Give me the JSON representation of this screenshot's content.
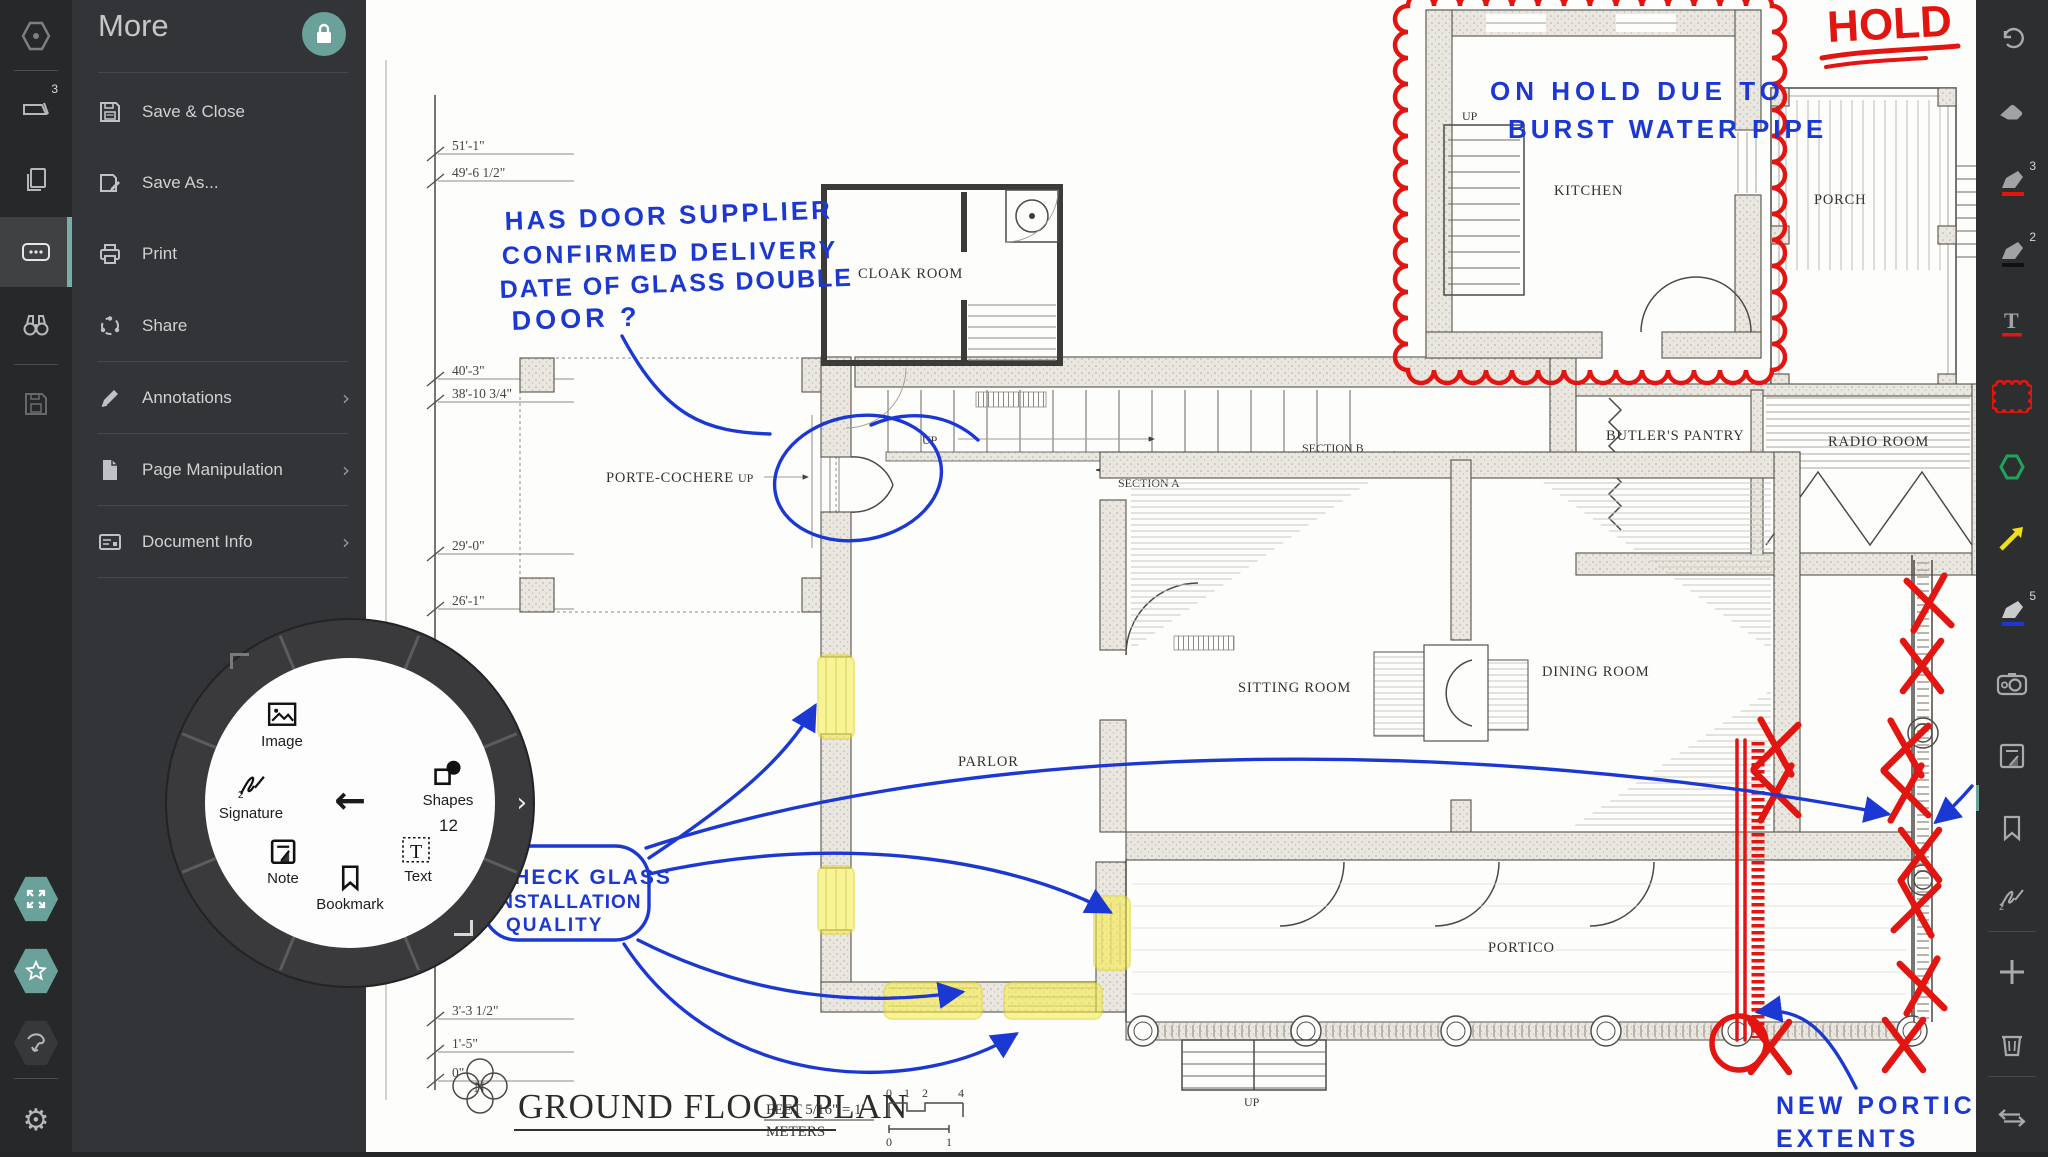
{
  "ui": {
    "more_panel": {
      "title": "More",
      "items": [
        {
          "label": "Save & Close"
        },
        {
          "label": "Save As..."
        },
        {
          "label": "Print"
        },
        {
          "label": "Share"
        },
        {
          "label": "Annotations"
        },
        {
          "label": "Page Manipulation"
        },
        {
          "label": "Document Info"
        }
      ]
    },
    "rail": {
      "documents_badge": "3"
    },
    "radial_menu": {
      "image": "Image",
      "signature": "Signature",
      "note": "Note",
      "bookmark": "Bookmark",
      "text": "Text",
      "shapes": "Shapes",
      "text_size": "12"
    },
    "toolbar": {
      "pen_red_badge": "3",
      "pen_black_badge": "2",
      "pen_blue_badge": "5"
    }
  },
  "plan": {
    "title": "GROUND FLOOR PLAN",
    "compass": "N",
    "up": "UP",
    "rooms": {
      "cloak": "CLOAK ROOM",
      "kitchen": "KITCHEN",
      "porch": "PORCH",
      "porte_cochere": "PORTE-COCHERE",
      "stair_hall": "STAIR HALL",
      "section_a": "SECTION A",
      "section_b": "SECTION B",
      "parlor": "PARLOR",
      "sitting": "SITTING ROOM",
      "dining": "DINING ROOM",
      "butlers": "BUTLER'S PANTRY",
      "radio": "RADIO ROOM",
      "portico": "PORTICO"
    },
    "dims": [
      "51'-1\"",
      "49'-6 1/2\"",
      "40'-3\"",
      "38'-10 3/4\"",
      "29'-0\"",
      "26'-1\"",
      "3'-3 1/2\"",
      "1'-5\"",
      "0\""
    ],
    "scale": {
      "feet": "FEET 5/16\" = 1'",
      "meters": "METERS",
      "feet_ticks": [
        "0",
        "1",
        "2",
        "4"
      ],
      "meter_ticks": [
        "0",
        "1"
      ]
    },
    "ink": {
      "hold": "HOLD",
      "on_hold_1": "ON HOLD DUE TO",
      "on_hold_2": "BURST WATER PIPE",
      "door_q_1": "HAS DOOR SUPPLIER",
      "door_q_2": "CONFIRMED DELIVERY",
      "door_q_3": "DATE OF GLASS DOUBLE",
      "door_q_4": "DOOR ?",
      "glass_1": "CHECK GLASS",
      "glass_2": "INSTALLATION",
      "glass_3": "QUALITY",
      "portico_1": "NEW PORTICO",
      "portico_2": "EXTENTS"
    },
    "colors": {
      "ink_blue": "#1c38d2",
      "ink_red": "#e21511",
      "highlight": "#f7ee3f",
      "accent_teal": "#67a09a"
    }
  }
}
